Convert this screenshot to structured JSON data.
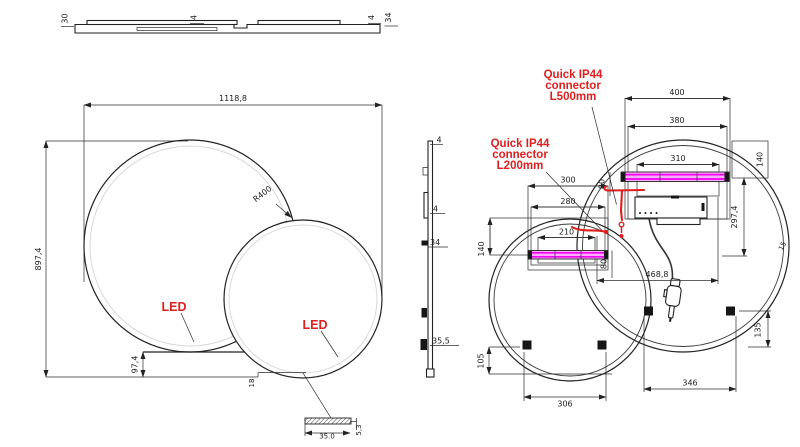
{
  "colors": {
    "red": "#de1f1f",
    "magenta": "#ef00ef",
    "magenta_fill": "#ffadff",
    "line": "#222222",
    "inner_rim_gray": "#d9d9d9"
  },
  "top_view": {
    "thickness_left": "30",
    "glass_a": "4",
    "glass_b": "4",
    "depth_right": "34"
  },
  "front_view": {
    "overall_width": "1118,8",
    "overall_height": "897,4",
    "radius_large": "R400",
    "bottom_offset": "97,4",
    "bottom_step": "18",
    "led_left": "LED",
    "led_right": "LED",
    "detail_width": "35.0",
    "detail_height": "5,3"
  },
  "side_view": {
    "glass_top": "4",
    "glass_mid": "4",
    "depth_mid": "34",
    "depth_bottom": "35,5"
  },
  "back_view": {
    "note_l500": {
      "line1": "Quick IP44",
      "line2": "connector",
      "line3": "L500mm"
    },
    "note_l200": {
      "line1": "Quick IP44",
      "line2": "connector",
      "line3": "L200mm"
    },
    "dims": {
      "w400": "400",
      "w380": "380",
      "w310": "310",
      "h140_right": "140",
      "w300": "300",
      "w280": "280",
      "w210": "210",
      "h140_left": "140",
      "h80_left": "80",
      "h80_right": "80",
      "h297": "297,4",
      "w468": "468,8",
      "h105": "105",
      "w306": "306",
      "w346": "346",
      "h135": "135",
      "rim15": "15"
    }
  }
}
